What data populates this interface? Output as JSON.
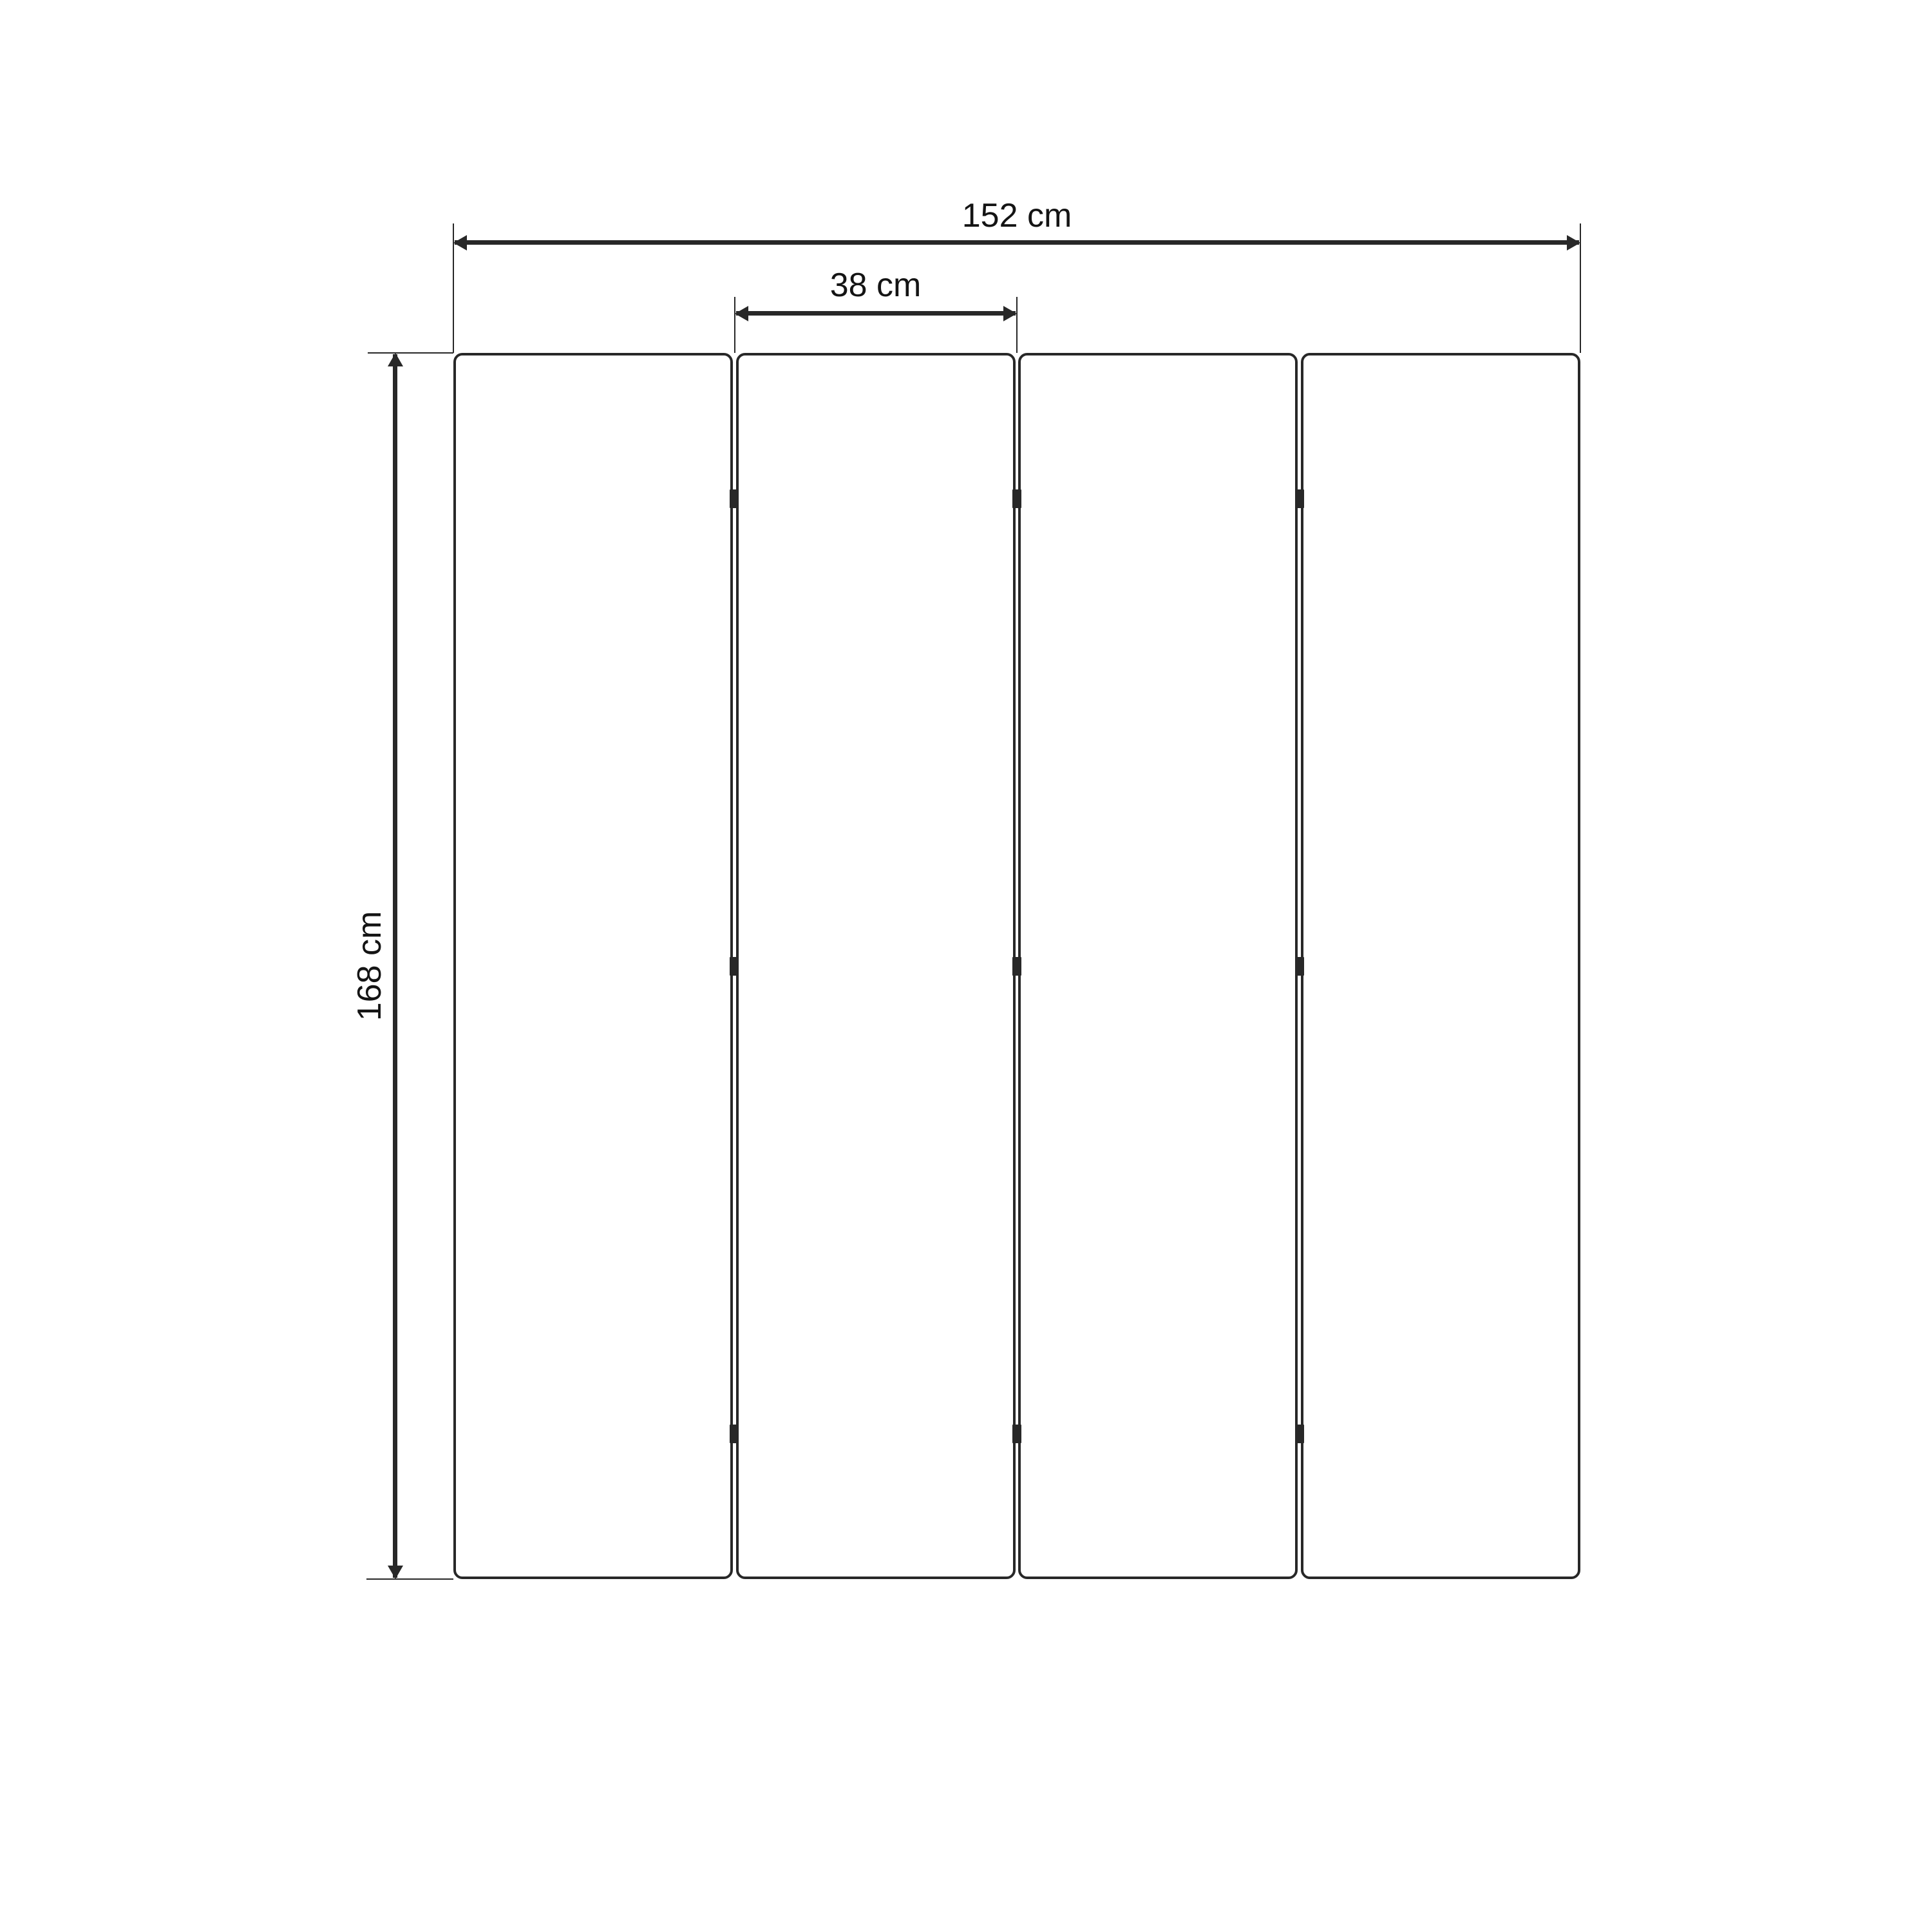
{
  "page": {
    "background": "#ffffff",
    "line_color": "#282828",
    "text_color": "#141414"
  },
  "drawing": {
    "panel_count": 4,
    "hinge_rows_per_gap": 3,
    "dimensions": {
      "total_width": {
        "label": "152 cm",
        "orientation": "horizontal"
      },
      "panel_width": {
        "label": "38 cm",
        "orientation": "horizontal"
      },
      "height": {
        "label": "168 cm",
        "orientation": "vertical"
      }
    }
  }
}
